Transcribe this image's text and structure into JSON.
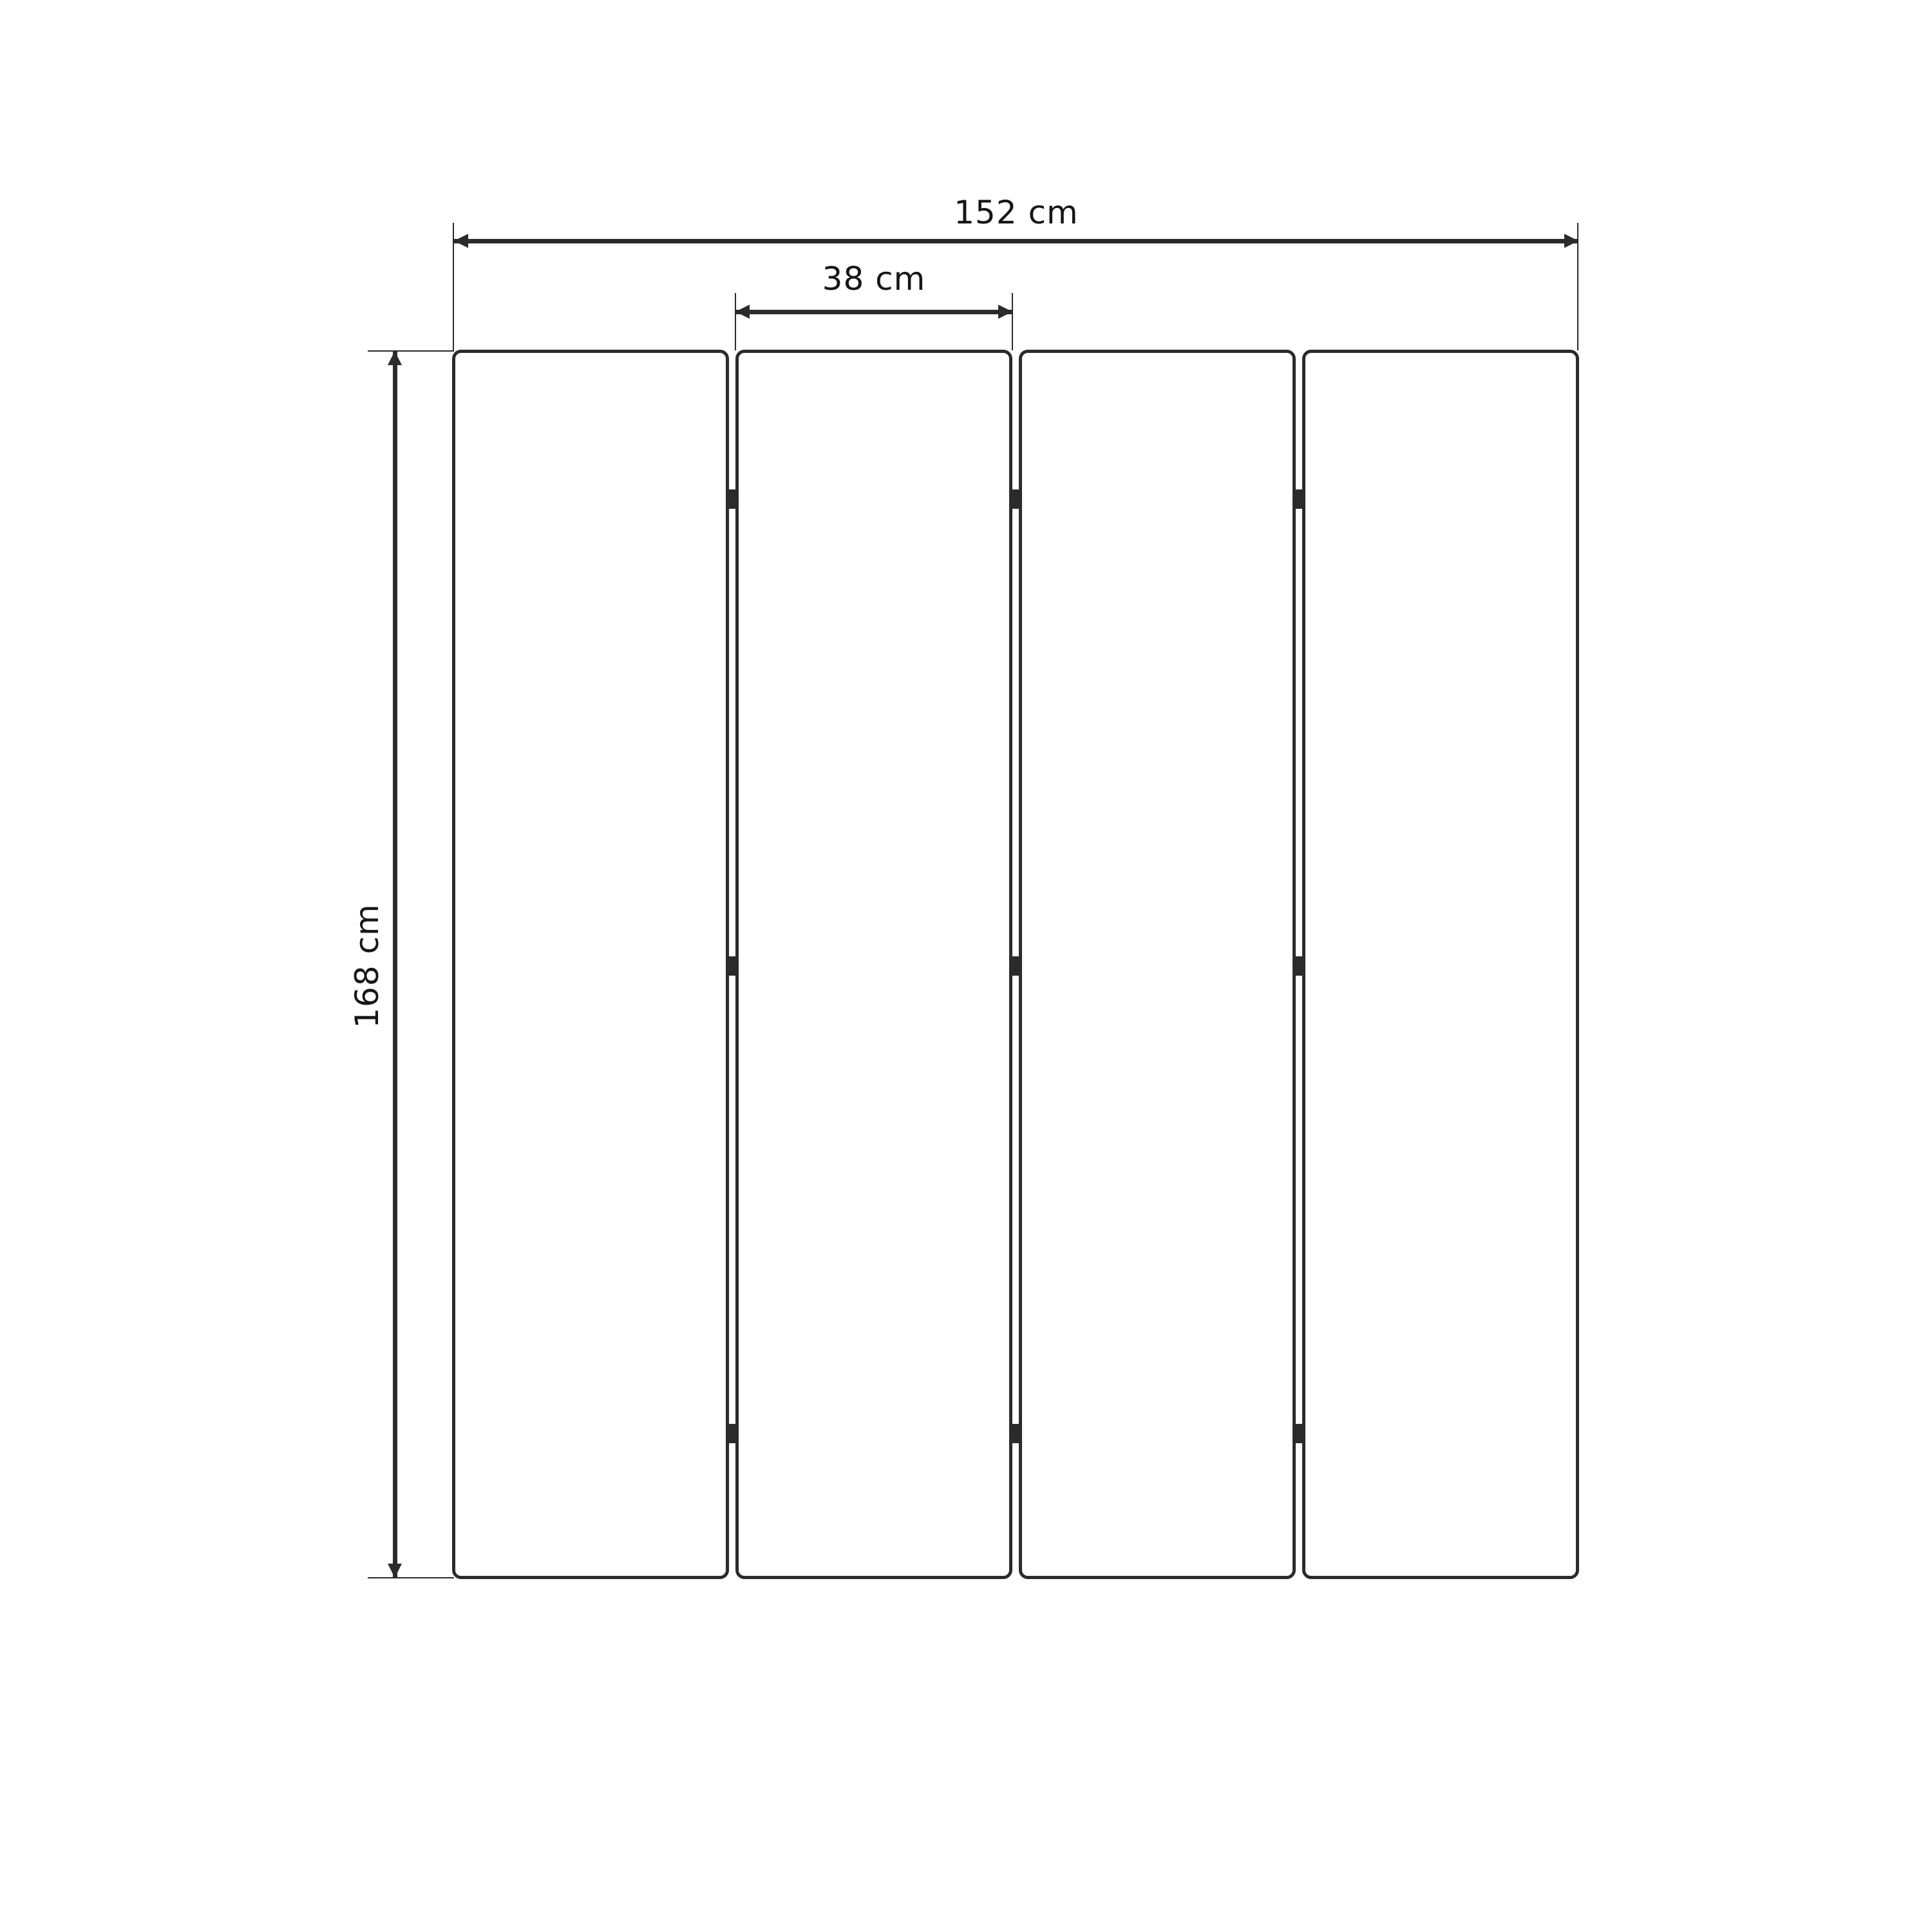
{
  "colors": {
    "line": "#2b2b2b",
    "text": "#161616",
    "bg": "#ffffff"
  },
  "diagram": {
    "type": "dimension-drawing",
    "panels": {
      "count": 4
    },
    "hinges": {
      "count": 9
    },
    "dimensions": {
      "total_width": {
        "value": 152,
        "unit": "cm",
        "label": "152 cm"
      },
      "panel_width": {
        "value": 38,
        "unit": "cm",
        "label": "38 cm"
      },
      "height": {
        "value": 168,
        "unit": "cm",
        "label": "168 cm"
      }
    }
  }
}
